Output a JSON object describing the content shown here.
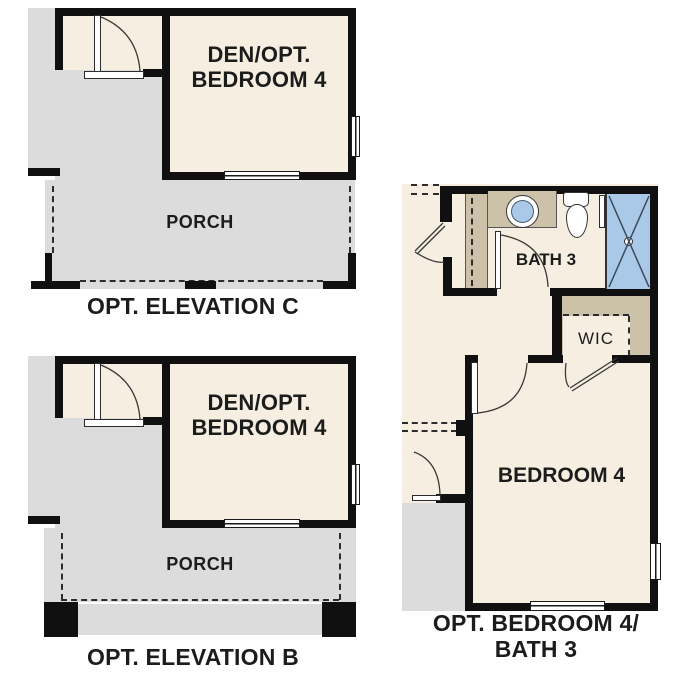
{
  "plans": {
    "elevation_c": {
      "den_line1": "DEN/OPT.",
      "den_line2": "BEDROOM 4",
      "porch_label": "PORCH",
      "caption": "OPT. ELEVATION C"
    },
    "elevation_b": {
      "den_line1": "DEN/OPT.",
      "den_line2": "BEDROOM 4",
      "porch_label": "PORCH",
      "caption": "OPT. ELEVATION B"
    },
    "opt_bedroom4_bath3": {
      "bath_label": "BATH 3",
      "wic_label": "WIC",
      "bedroom_label": "BEDROOM 4",
      "caption_line1": "OPT. BEDROOM 4/",
      "caption_line2": "BATH 3"
    }
  },
  "colors": {
    "floor_cream": "#f6efe1",
    "floor_gray": "#dcdcdc",
    "counter_tan": "#ccc2aa",
    "fixture_blue": "#aac9e9",
    "wall_black": "#101010",
    "text_black": "#1c1c1c"
  }
}
